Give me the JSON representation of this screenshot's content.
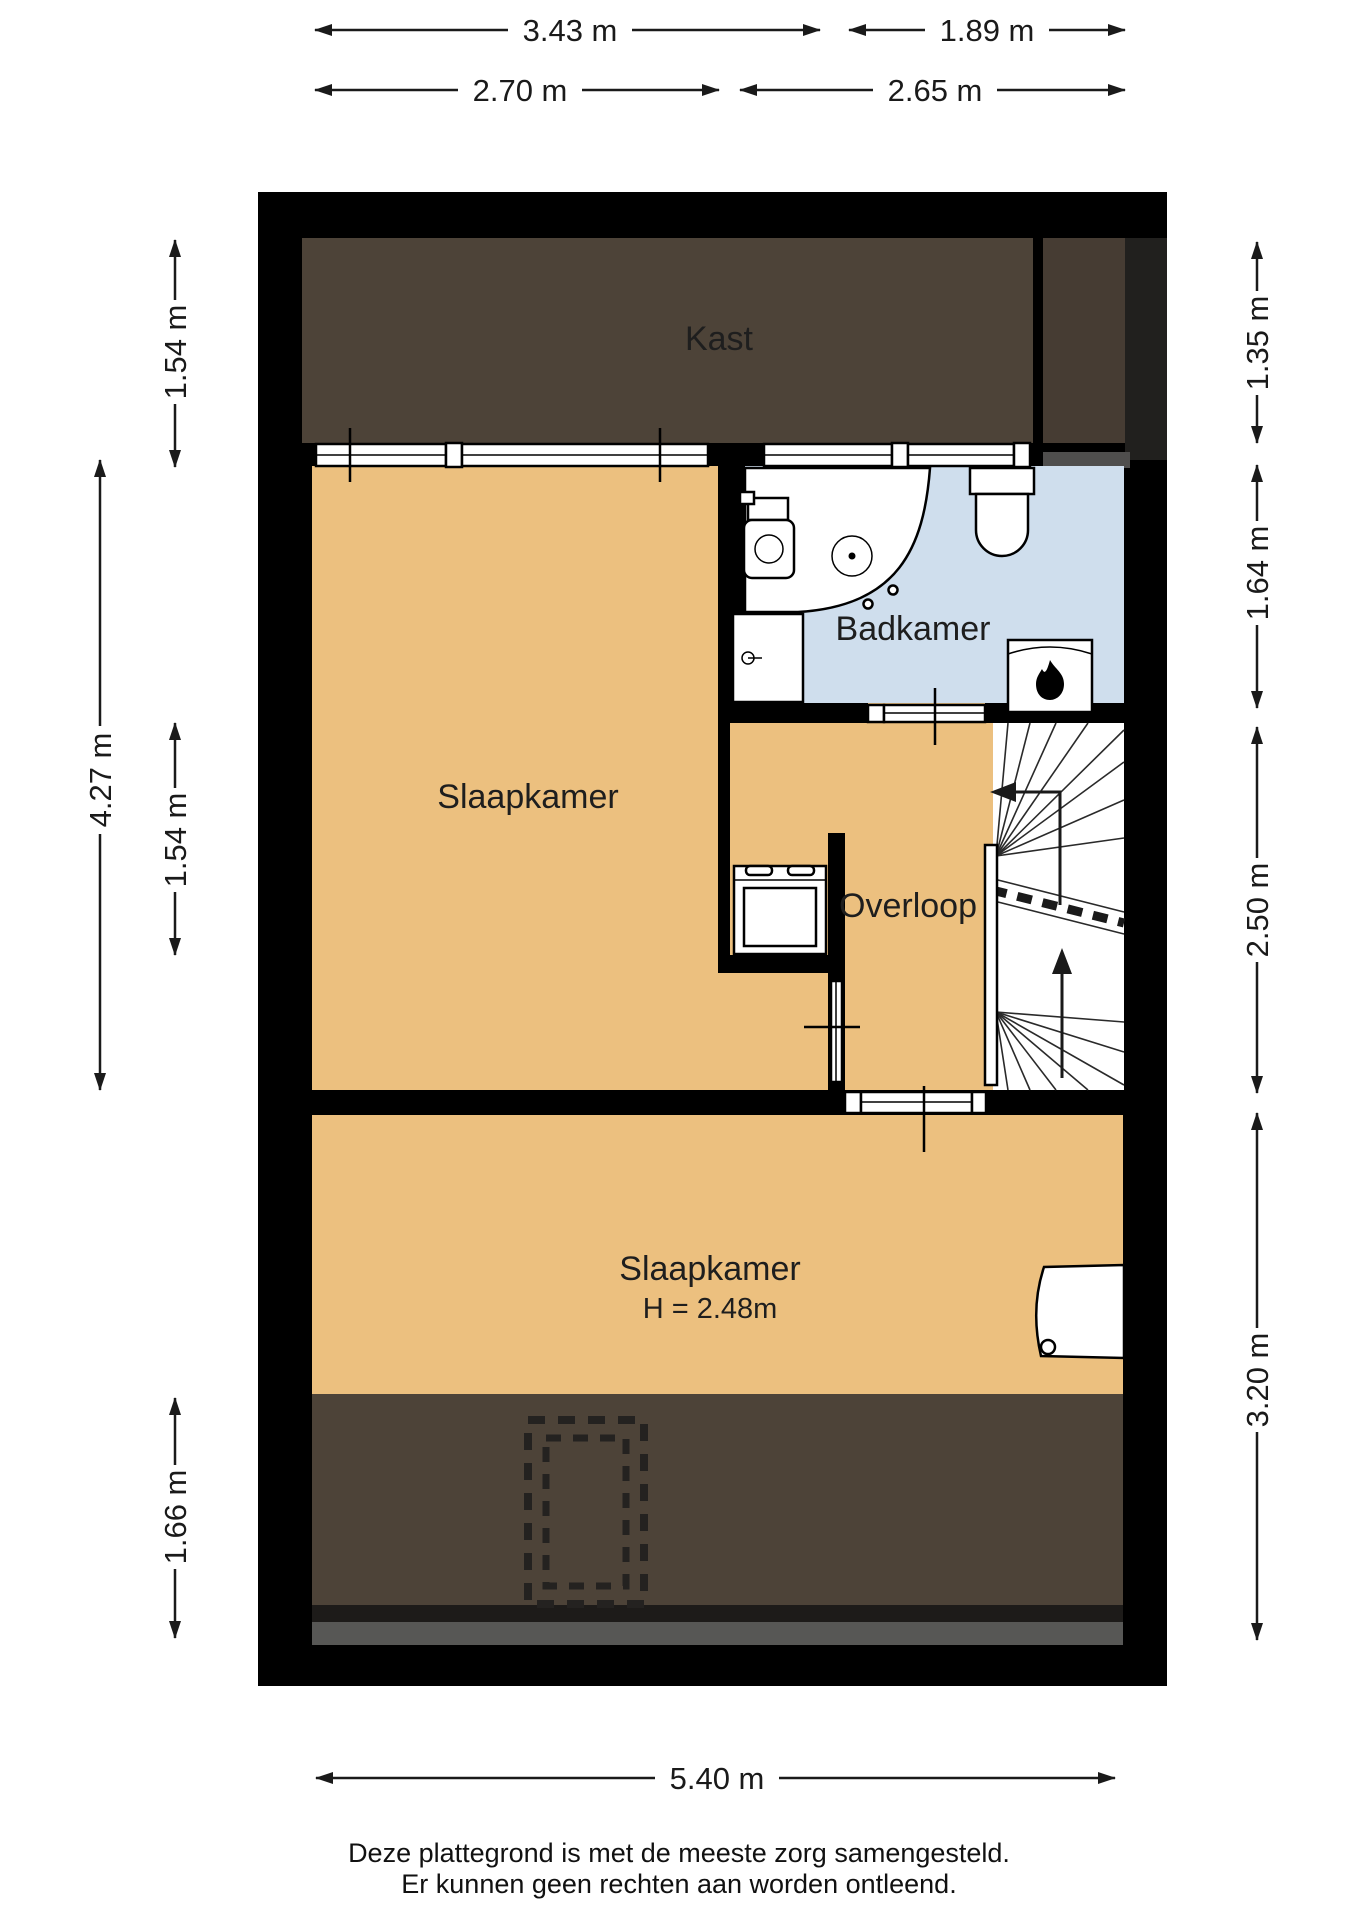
{
  "title": "Plattegrond verdieping",
  "rooms": {
    "kast": "Kast",
    "slaapkamer1": "Slaapkamer",
    "badkamer": "Badkamer",
    "overloop": "Overloop",
    "slaapkamer2": "Slaapkamer",
    "slaapkamer2_height": "H = 2.48m"
  },
  "dimensions": {
    "top_outer_left": "3.43 m",
    "top_outer_right": "1.89 m",
    "top_inner_left": "2.70 m",
    "top_inner_right": "2.65 m",
    "left_kast": "1.54 m",
    "left_bedroom": "4.27 m",
    "left_overloop": "1.54 m",
    "left_attic": "1.66 m",
    "right_kast": "1.35 m",
    "right_bathroom": "1.64 m",
    "right_stairs": "2.50 m",
    "right_bedroom": "3.20 m",
    "bottom_total": "5.40 m"
  },
  "footer": {
    "line1": "Deze plattegrond is met de meeste zorg samengesteld.",
    "line2": "Er kunnen geen rechten aan worden ontleend."
  },
  "colors": {
    "wall": "#000000",
    "floor_bedroom": "#ecc07f",
    "floor_bathroom": "#cfdeed",
    "floor_attic": "#4d4338",
    "floor_attic_right": "#463c33",
    "attic_strip_dark": "#1d1b19",
    "attic_strip_gray": "#575755",
    "halfwall_gray": "#4f4e4d",
    "wall_shadow": "#21201e"
  }
}
